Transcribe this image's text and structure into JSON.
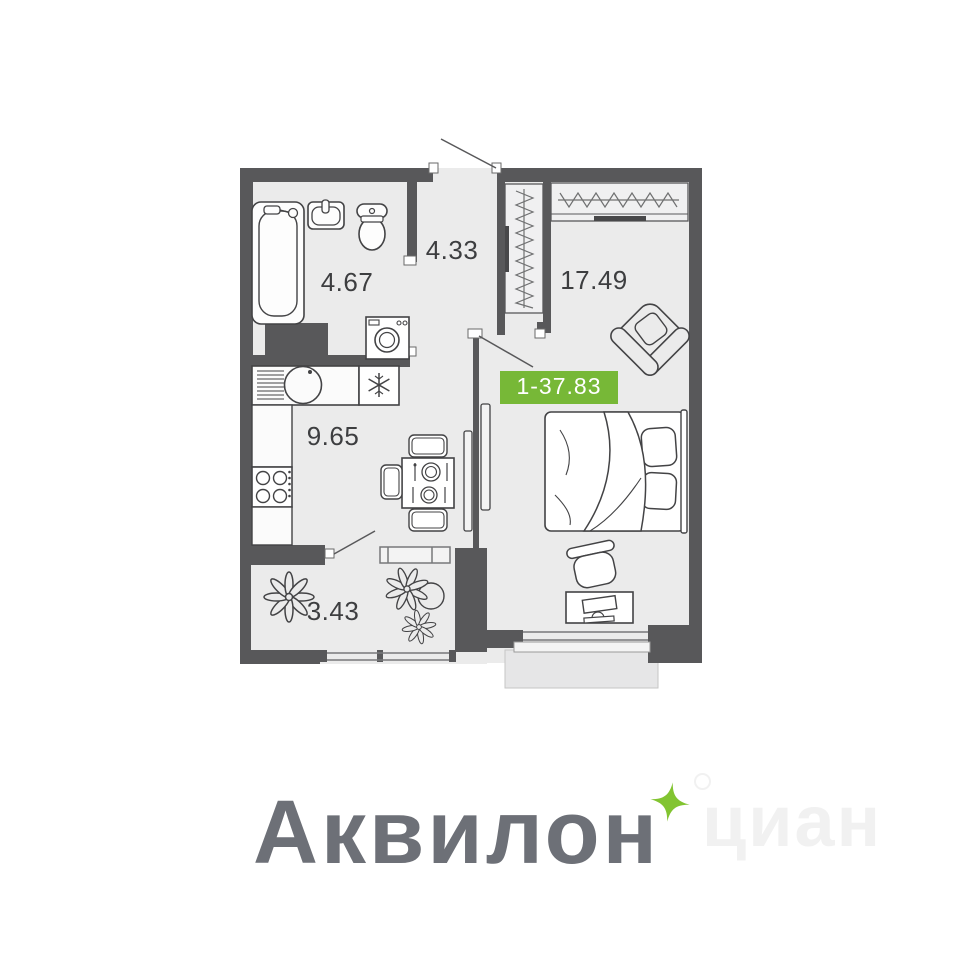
{
  "plan": {
    "badge": {
      "label": "1-37.83",
      "color": "#77b837",
      "text_color": "#ffffff"
    },
    "rooms": {
      "bathroom": {
        "area": "4.67"
      },
      "hallway": {
        "area": "4.33"
      },
      "living_room": {
        "area": "17.49"
      },
      "kitchen": {
        "area": "9.65"
      },
      "balcony": {
        "area": "3.43"
      }
    },
    "colors": {
      "wall": "#58585a",
      "floor": "#ebebeb",
      "furniture_line": "#434345"
    },
    "icons": {
      "fridge": "snowflake",
      "wardrobe": "hanger-hatching",
      "balcony_plants": "plant-top-view",
      "doors": "quarter-swing-line"
    }
  },
  "branding": {
    "logo_text": "Аквилон",
    "logo_color": "#6d7077",
    "sparkle_color": "#82c431",
    "watermark_text": "циан",
    "watermark_color": "#f1f1f1"
  }
}
